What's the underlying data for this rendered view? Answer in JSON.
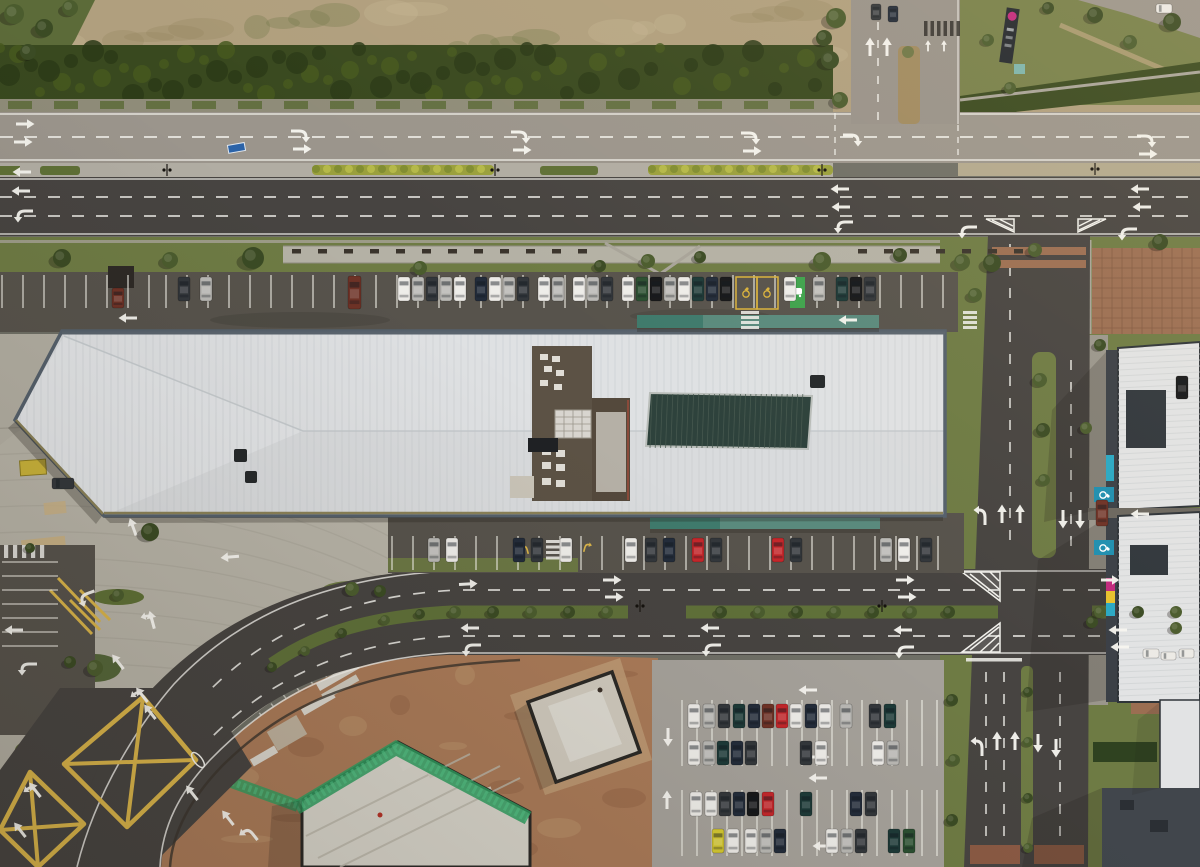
{
  "meta": {
    "title": "Aerial drone photograph: retail-park warehouse with white roof, dual-carriageway roads, parking lots and construction site",
    "width": 1200,
    "height": 867
  },
  "palette": {
    "dirt": "#b09f7e",
    "dirt_dark": "#96855f",
    "dirt_light": "#c7b795",
    "scrub_green": "#6f7747",
    "grass": "#6e7b44",
    "grass_dark": "#55663a",
    "hedge": "#39491f",
    "hedge_dark": "#2c3a18",
    "road_light": "#9b958c",
    "road_dark": "#474441",
    "asphalt_lot": "#57534c",
    "lot_light": "#a5a19a",
    "plaza": "#b2aea2",
    "plaza_line": "#8e8a7e",
    "paver_tan": "#c9b083",
    "marking_white": "#f2f1ec",
    "marking_yellow": "#d9b44a",
    "median_bush": "#9aa03c",
    "median_base": "#b1ada3",
    "median_tan": "#b3a98e",
    "roof": "#d9dbdd",
    "roof_line": "#c6cacd",
    "roof_edge": "#55606b",
    "roof_trim": "#8a8158",
    "skylight": "#2e423c",
    "skylight_line": "#485a50",
    "well_floor": "#5c5245",
    "hvac": "#d8d5cf",
    "pad": "#b5b0a6",
    "canopy": "#3f7a6c",
    "canopy_light": "#5b8d80",
    "tree": "#4b5c2e",
    "tree_dark": "#3b4b24",
    "bench": "#3a342c",
    "construction_dirt": "#a97a58",
    "construction_dirt2": "#c19a72",
    "sand": "#c9a87e",
    "mesh_green": "#2f9e60",
    "build_white": "#e2e3e4",
    "build_dark": "#3a3f46",
    "brown_tile": "#9b6e52",
    "brown_line": "#7e573f",
    "blue_badge": "#1f8fb0",
    "ev_green": "#3fa34d",
    "sign_magenta": "#c2297d",
    "shadow": "#241f19",
    "car_white": "#eceae6",
    "car_silver": "#b9b8b4",
    "car_black": "#17181a",
    "car_dark": "#33373b",
    "car_navy": "#232c3a",
    "car_teal": "#1d3a38",
    "car_red": "#c3272b",
    "car_maroon": "#6e3226",
    "car_yellow": "#d4c832",
    "car_green": "#2b4f31"
  },
  "scene": {
    "vehicles": {
      "north_row_y": 277,
      "north_row": [
        [
          178,
          "dark"
        ],
        [
          200,
          "silver"
        ],
        [
          398,
          "white"
        ],
        [
          412,
          "silver"
        ],
        [
          426,
          "dark"
        ],
        [
          440,
          "silver"
        ],
        [
          454,
          "white"
        ],
        [
          475,
          "navy"
        ],
        [
          489,
          "white"
        ],
        [
          503,
          "silver"
        ],
        [
          517,
          "dark"
        ],
        [
          538,
          "white"
        ],
        [
          552,
          "silver"
        ],
        [
          573,
          "white"
        ],
        [
          587,
          "silver"
        ],
        [
          601,
          "dark"
        ],
        [
          622,
          "white"
        ],
        [
          636,
          "green"
        ],
        [
          650,
          "black"
        ],
        [
          664,
          "silver"
        ],
        [
          678,
          "white"
        ],
        [
          692,
          "teal"
        ],
        [
          706,
          "navy"
        ],
        [
          720,
          "black"
        ],
        [
          784,
          "white"
        ],
        [
          813,
          "silver"
        ],
        [
          836,
          "teal"
        ],
        [
          850,
          "black"
        ],
        [
          864,
          "dark"
        ]
      ],
      "south_row_y": 538,
      "south_row": [
        [
          428,
          "silver"
        ],
        [
          446,
          "white"
        ],
        [
          513,
          "navy"
        ],
        [
          531,
          "dark"
        ],
        [
          560,
          "white"
        ],
        [
          625,
          "white"
        ],
        [
          645,
          "dark"
        ],
        [
          663,
          "navy"
        ],
        [
          692,
          "red"
        ],
        [
          710,
          "dark"
        ],
        [
          772,
          "red"
        ],
        [
          790,
          "dark"
        ],
        [
          880,
          "silver"
        ],
        [
          898,
          "white"
        ],
        [
          920,
          "dark"
        ]
      ],
      "lot_rows": [
        {
          "y": 704,
          "cars": [
            [
              688,
              "white"
            ],
            [
              703,
              "silver"
            ],
            [
              718,
              "dark"
            ],
            [
              733,
              "teal"
            ],
            [
              748,
              "navy"
            ],
            [
              762,
              "maroon"
            ],
            [
              776,
              "red"
            ],
            [
              790,
              "white"
            ],
            [
              805,
              "navy"
            ],
            [
              819,
              "white"
            ],
            [
              840,
              "silver"
            ],
            [
              869,
              "dark"
            ],
            [
              884,
              "teal"
            ]
          ]
        },
        {
          "y": 741,
          "cars": [
            [
              688,
              "white"
            ],
            [
              703,
              "silver"
            ],
            [
              717,
              "teal"
            ],
            [
              731,
              "navy"
            ],
            [
              745,
              "dark"
            ],
            [
              800,
              "dark"
            ],
            [
              815,
              "white"
            ],
            [
              872,
              "white"
            ],
            [
              887,
              "silver"
            ]
          ]
        },
        {
          "y": 792,
          "cars": [
            [
              690,
              "white"
            ],
            [
              705,
              "white"
            ],
            [
              719,
              "dark"
            ],
            [
              733,
              "navy"
            ],
            [
              747,
              "black"
            ],
            [
              762,
              "red"
            ],
            [
              800,
              "teal"
            ],
            [
              850,
              "navy"
            ],
            [
              865,
              "dark"
            ]
          ]
        },
        {
          "y": 829,
          "cars": [
            [
              712,
              "yellow"
            ],
            [
              727,
              "white"
            ],
            [
              745,
              "white"
            ],
            [
              760,
              "silver"
            ],
            [
              774,
              "navy"
            ],
            [
              826,
              "white"
            ],
            [
              841,
              "silver"
            ],
            [
              855,
              "dark"
            ],
            [
              888,
              "teal"
            ],
            [
              903,
              "green"
            ]
          ]
        }
      ],
      "misc": [
        [
          348,
          276,
          "maroon",
          13,
          33
        ],
        [
          112,
          288,
          "maroon",
          12,
          20
        ],
        [
          52,
          478,
          "dark",
          22,
          11
        ],
        [
          1176,
          376,
          "black",
          12,
          23
        ],
        [
          1096,
          500,
          "maroon",
          12,
          26
        ],
        [
          1143,
          649,
          "white",
          16,
          9
        ],
        [
          1161,
          652,
          "white",
          15,
          8
        ],
        [
          1179,
          649,
          "white",
          15,
          9
        ],
        [
          1156,
          4,
          "white",
          16,
          9
        ],
        [
          871,
          4,
          "dark",
          10,
          16
        ],
        [
          888,
          6,
          "navy",
          10,
          16
        ]
      ]
    },
    "trees": [
      [
        62,
        258,
        9
      ],
      [
        170,
        260,
        8
      ],
      [
        253,
        258,
        11
      ],
      [
        420,
        268,
        7
      ],
      [
        600,
        266,
        6
      ],
      [
        648,
        261,
        7
      ],
      [
        700,
        257,
        6
      ],
      [
        822,
        261,
        9
      ],
      [
        900,
        255,
        7
      ],
      [
        962,
        262,
        8
      ],
      [
        992,
        263,
        9
      ],
      [
        1035,
        250,
        7
      ],
      [
        1160,
        242,
        8
      ],
      [
        975,
        295,
        7
      ],
      [
        150,
        532,
        9
      ],
      [
        352,
        589,
        7
      ],
      [
        380,
        591,
        6
      ],
      [
        118,
        595,
        6
      ],
      [
        30,
        548,
        5
      ],
      [
        95,
        668,
        8
      ],
      [
        70,
        662,
        6
      ],
      [
        1040,
        380,
        7
      ],
      [
        1043,
        430,
        7
      ],
      [
        1044,
        480,
        6
      ],
      [
        1028,
        692,
        5
      ],
      [
        1028,
        742,
        5
      ],
      [
        1028,
        798,
        5
      ],
      [
        1028,
        848,
        5
      ],
      [
        1095,
        15,
        8
      ],
      [
        1130,
        42,
        7
      ],
      [
        1172,
        22,
        9
      ],
      [
        988,
        40,
        6
      ],
      [
        1048,
        8,
        6
      ],
      [
        1010,
        88,
        6
      ],
      [
        1100,
        345,
        6
      ],
      [
        1086,
        428,
        6
      ],
      [
        1092,
        622,
        6
      ],
      [
        1176,
        628,
        6
      ],
      [
        952,
        700,
        6
      ],
      [
        954,
        760,
        6
      ],
      [
        952,
        820,
        6
      ],
      [
        14,
        14,
        10
      ],
      [
        44,
        28,
        9
      ],
      [
        70,
        8,
        8
      ],
      [
        28,
        52,
        8
      ],
      [
        836,
        18,
        10
      ],
      [
        830,
        60,
        9
      ],
      [
        840,
        100,
        8
      ],
      [
        824,
        38,
        8
      ],
      [
        455,
        612,
        6
      ],
      [
        493,
        612,
        6
      ],
      [
        531,
        612,
        6
      ],
      [
        569,
        612,
        6
      ],
      [
        607,
        612,
        6
      ],
      [
        721,
        612,
        6
      ],
      [
        759,
        612,
        6
      ],
      [
        797,
        612,
        6
      ],
      [
        835,
        612,
        6
      ],
      [
        873,
        612,
        6
      ],
      [
        911,
        612,
        6
      ],
      [
        949,
        612,
        6
      ],
      [
        1100,
        612,
        6
      ],
      [
        1138,
        612,
        6
      ],
      [
        1176,
        612,
        6
      ],
      [
        420,
        614,
        5
      ],
      [
        385,
        620,
        5
      ],
      [
        342,
        633,
        5
      ],
      [
        305,
        651,
        5
      ],
      [
        272,
        667,
        5
      ]
    ],
    "arrows": [
      [
        25,
        124,
        "s",
        90
      ],
      [
        23,
        142,
        "s",
        90
      ],
      [
        300,
        131,
        "cr",
        90
      ],
      [
        302,
        149,
        "s",
        90
      ],
      [
        520,
        132,
        "cr",
        90
      ],
      [
        522,
        150,
        "s",
        90
      ],
      [
        750,
        133,
        "cr",
        90
      ],
      [
        752,
        151,
        "s",
        90
      ],
      [
        852,
        135,
        "cr",
        90
      ],
      [
        1146,
        136,
        "cr",
        90
      ],
      [
        1148,
        154,
        "s",
        90
      ],
      [
        22,
        172,
        "s",
        -90
      ],
      [
        21,
        191,
        "s",
        -90
      ],
      [
        24,
        211,
        "cl",
        -90
      ],
      [
        840,
        189,
        "s",
        -90
      ],
      [
        841,
        207,
        "s",
        -90
      ],
      [
        844,
        222,
        "cl",
        -90
      ],
      [
        1140,
        189,
        "s",
        -90
      ],
      [
        1142,
        207,
        "s",
        -90
      ],
      [
        968,
        227,
        "cl",
        -90
      ],
      [
        1128,
        229,
        "cl",
        -90
      ],
      [
        870,
        47,
        "s",
        0
      ],
      [
        887,
        47,
        "s",
        0
      ],
      [
        928,
        46,
        "s",
        0,
        0.6
      ],
      [
        944,
        46,
        "s",
        0,
        0.6
      ],
      [
        128,
        318,
        "s",
        -90
      ],
      [
        848,
        320,
        "s",
        -90
      ],
      [
        230,
        557,
        "s",
        -95
      ],
      [
        133,
        527,
        "s",
        -20
      ],
      [
        86,
        594,
        "cl",
        -110
      ],
      [
        152,
        620,
        "f",
        -15
      ],
      [
        612,
        580,
        "s",
        90
      ],
      [
        614,
        597,
        "s",
        90
      ],
      [
        905,
        580,
        "s",
        90
      ],
      [
        907,
        597,
        "s",
        90
      ],
      [
        1110,
        580,
        "s",
        90
      ],
      [
        468,
        584,
        "s",
        87
      ],
      [
        470,
        628,
        "s",
        -90
      ],
      [
        472,
        645,
        "cl",
        -90
      ],
      [
        710,
        628,
        "s",
        -90
      ],
      [
        712,
        645,
        "cl",
        -90
      ],
      [
        903,
        630,
        "s",
        -90
      ],
      [
        905,
        647,
        "cl",
        -90
      ],
      [
        1118,
        630,
        "s",
        -90
      ],
      [
        1120,
        647,
        "s",
        -90
      ],
      [
        142,
        695,
        "f",
        -38
      ],
      [
        150,
        712,
        "s",
        -38
      ],
      [
        192,
        793,
        "s",
        -38
      ],
      [
        228,
        818,
        "s",
        -38
      ],
      [
        252,
        833,
        "cl",
        -38
      ],
      [
        118,
        662,
        "s",
        -38
      ],
      [
        1002,
        514,
        "s",
        0
      ],
      [
        1020,
        514,
        "s",
        0
      ],
      [
        985,
        516,
        "cl",
        0
      ],
      [
        1063,
        519,
        "s",
        180
      ],
      [
        1080,
        519,
        "s",
        180
      ],
      [
        997,
        741,
        "s",
        0
      ],
      [
        1015,
        741,
        "s",
        0
      ],
      [
        982,
        747,
        "cl",
        0
      ],
      [
        1038,
        743,
        "s",
        180
      ],
      [
        1056,
        748,
        "s",
        180
      ],
      [
        808,
        690,
        "s",
        -90
      ],
      [
        820,
        757,
        "s",
        90
      ],
      [
        818,
        778,
        "s",
        -90
      ],
      [
        822,
        846,
        "s",
        -90
      ],
      [
        668,
        737,
        "s",
        180
      ],
      [
        667,
        800,
        "s",
        0
      ],
      [
        1140,
        514,
        "s",
        -90
      ],
      [
        14,
        630,
        "s",
        -90
      ],
      [
        28,
        664,
        "cl",
        -90
      ],
      [
        35,
        790,
        "f",
        -38
      ],
      [
        20,
        830,
        "s",
        -38
      ],
      [
        527,
        549,
        "cl",
        -15,
        0.55,
        "y"
      ],
      [
        585,
        547,
        "cr",
        15,
        0.55,
        "y"
      ]
    ],
    "stall_groups": [
      {
        "x1": 166,
        "x2": 956,
        "step": 21,
        "y1": 275,
        "y2": 308
      },
      {
        "x1": 2,
        "x2": 160,
        "step": 21,
        "y1": 275,
        "y2": 308
      },
      {
        "x1": 392,
        "x2": 956,
        "step": 21,
        "y1": 536,
        "y2": 570
      },
      {
        "x1": 682,
        "x2": 940,
        "step": 15,
        "y1": 700,
        "y2": 733
      },
      {
        "x1": 682,
        "x2": 940,
        "step": 15,
        "y1": 733,
        "y2": 766
      },
      {
        "x1": 682,
        "x2": 940,
        "step": 15,
        "y1": 790,
        "y2": 823
      },
      {
        "x1": 682,
        "x2": 940,
        "step": 15,
        "y1": 823,
        "y2": 856
      },
      {
        "x1": 2,
        "x2": 58,
        "step": 14,
        "y1": 562,
        "y2": 646,
        "horiz": true
      }
    ],
    "benches": [
      {
        "x1": 292,
        "x2": 578,
        "step": 26,
        "y": 249
      },
      {
        "x1": 858,
        "x2": 1032,
        "step": 26,
        "y": 249
      }
    ],
    "ladders": [
      {
        "x": 741,
        "y": 311,
        "n": 4,
        "w": 18,
        "gap": 5
      },
      {
        "x": 963,
        "y": 311,
        "n": 4,
        "w": 14,
        "gap": 5
      },
      {
        "x": 546,
        "y": 540,
        "n": 4,
        "w": 18,
        "gap": 5.5
      },
      {
        "x": 4,
        "y": 545,
        "n": 5,
        "w": 13,
        "gap": 9,
        "vert": true
      }
    ],
    "dark_bars": {
      "x": 924,
      "y": 21,
      "n": 6,
      "gap": 6.5,
      "h": 15,
      "w": 3.5,
      "color": "#2e2c28"
    },
    "lamps": [
      [
        167,
        170
      ],
      [
        495,
        170
      ],
      [
        822,
        170
      ],
      [
        1095,
        169
      ],
      [
        640,
        606
      ],
      [
        882,
        606
      ]
    ],
    "accessible_spots": {
      "north": [
        [
          746,
          293
        ],
        [
          767,
          293
        ]
      ],
      "east": [
        [
          1104,
          495
        ],
        [
          1104,
          548
        ]
      ]
    },
    "ev_spot": {
      "x": 790,
      "y": 277,
      "w": 15,
      "h": 31
    }
  }
}
